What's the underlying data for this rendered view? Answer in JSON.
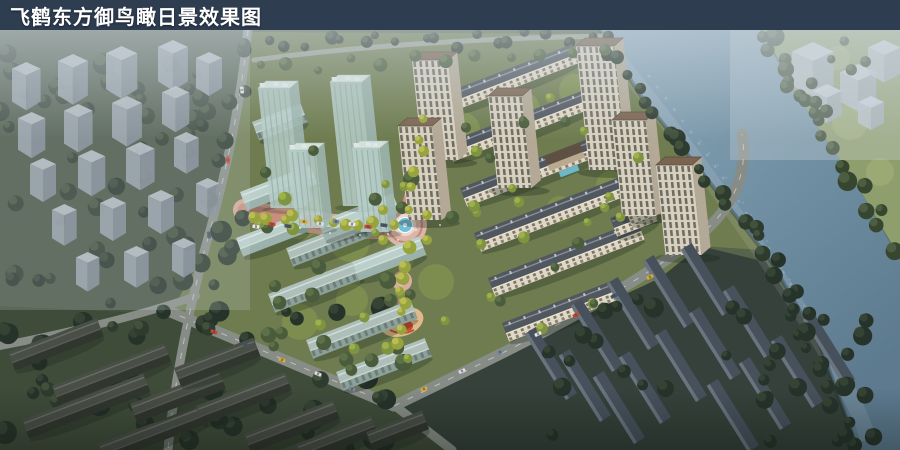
{
  "title_bar": {
    "text": "飞鹤东方御鸟瞰日景效果图",
    "background": "#2e3d50",
    "text_color": "#ffffff"
  },
  "scene": {
    "type": "aerial-architectural-rendering",
    "palette": {
      "river": "#87a1b3",
      "river_deep": "#5d7a8e",
      "dev_ground": "#6e7c4f",
      "context_ground_west": "#465443",
      "context_ground_south": "#3f4c3a",
      "context_ground_southeast": "#35413a",
      "base_ground": "#57644b",
      "far_bank_grass": "#8f9e6d",
      "foliage_dark": "#2e3b2f",
      "foliage_bright": "#a9b24d",
      "facade_cream": "#ddd5c2",
      "roof_dark": "#51575f",
      "roof_brown": "#7a6450",
      "glass_massing": "#b7cec8",
      "context_massing": "#9aa5b0",
      "far_massing": "#ccd4e0",
      "promenade": "#c98e7e",
      "plaza": "#dbb6a8",
      "pool": "#6fc0d8",
      "playground": "#d2622e",
      "road": "#878d86",
      "haze": "#d0dae2"
    }
  }
}
